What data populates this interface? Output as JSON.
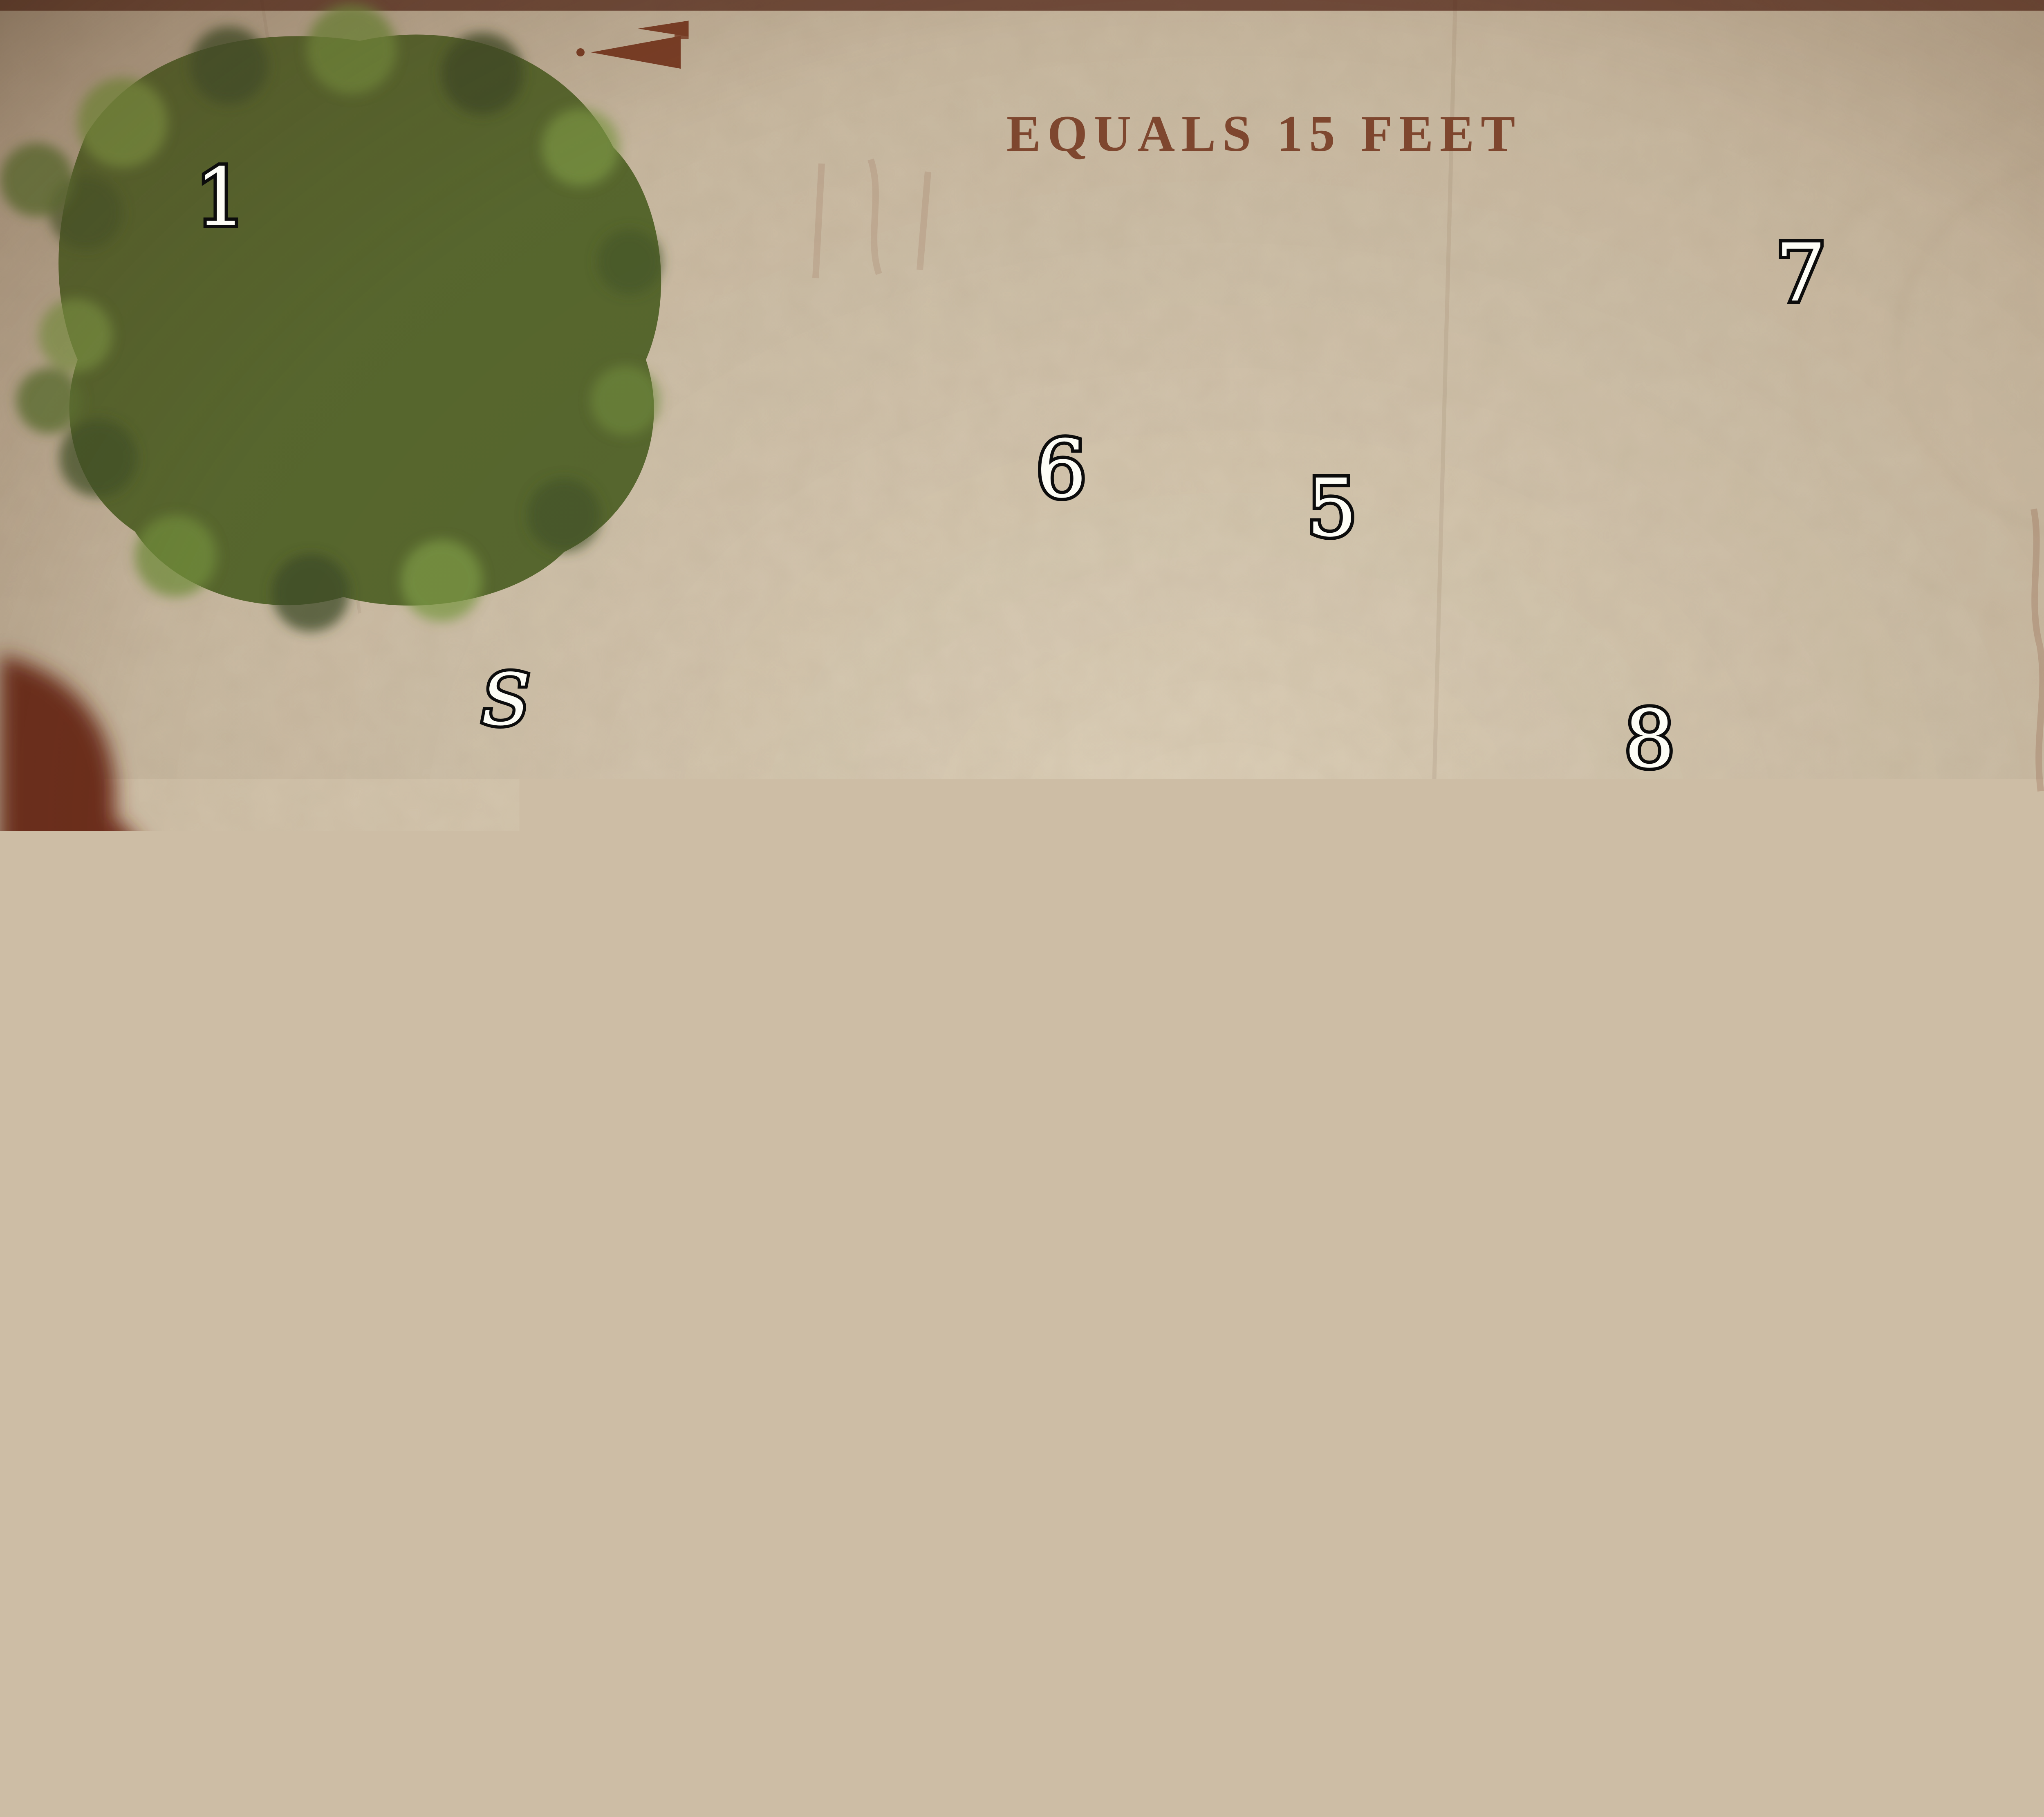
{
  "title": {
    "line1": "NERONVAIN'S",
    "line2": "STRONGHOLD"
  },
  "legend": {
    "text": "EQUALS 15 FEET"
  },
  "compass": {
    "label": "N"
  },
  "credit": {
    "artist": "BLANDO"
  },
  "rooms": [
    {
      "label": "1"
    },
    {
      "label": "2"
    },
    {
      "label": "3"
    },
    {
      "label": "4"
    },
    {
      "label": "5"
    },
    {
      "label": "6"
    },
    {
      "label": "7"
    },
    {
      "label": "8"
    },
    {
      "label": "9"
    },
    {
      "label": "10"
    }
  ],
  "secret_doors": [
    {
      "label": "S"
    },
    {
      "label": "S"
    },
    {
      "label": "S"
    }
  ],
  "colors": {
    "parchment": "#cdbda5",
    "rust_ink": "#7c3e26",
    "blood_splotch": "#6e2f1c",
    "water_green": "#4a6a5d",
    "floor_stone": "#c6b7a0",
    "wall_stone": "#8b7a63",
    "title_cream": "#eadfc6",
    "label_white": "#fdfdf6",
    "compass_olive": "#b3b089",
    "lake_dark": "#272e2c",
    "foliage_green": "#58692f"
  }
}
